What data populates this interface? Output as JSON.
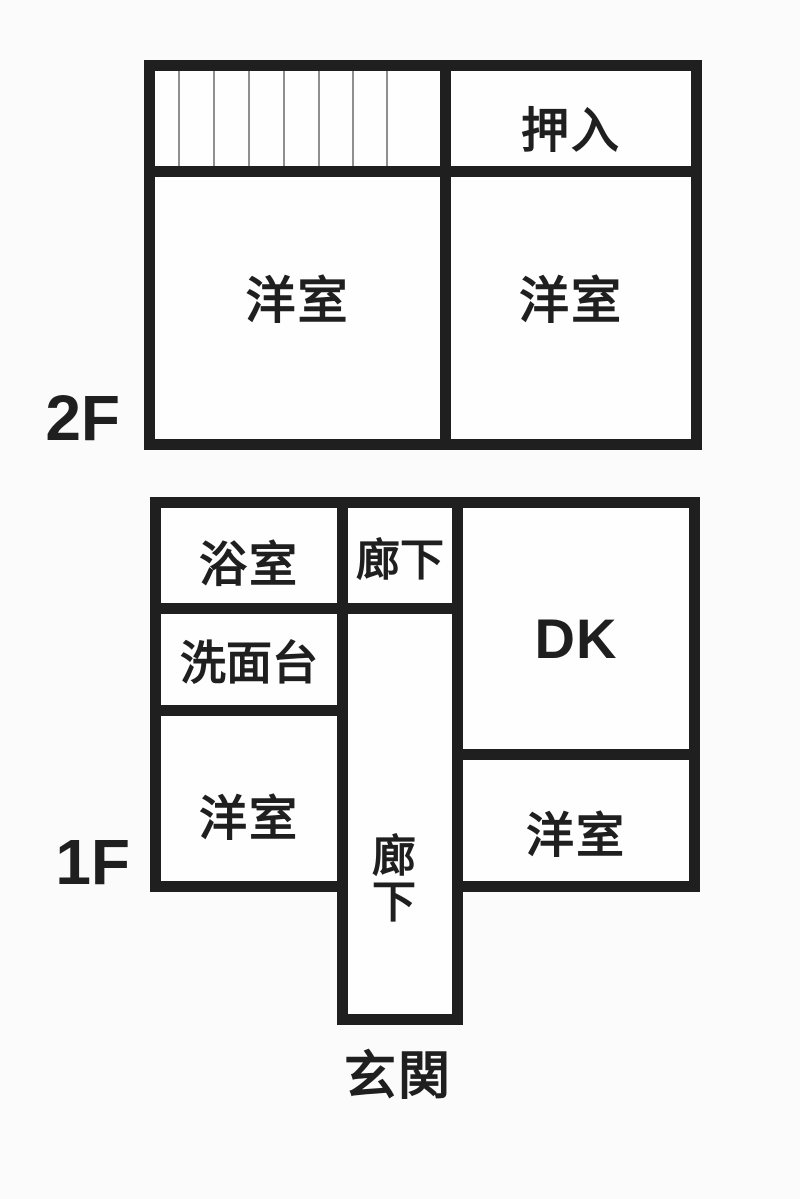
{
  "floorplan": {
    "floor_2f": {
      "label": "2F",
      "rooms": {
        "oshiire": "押入",
        "yoshitsu_left": "洋室",
        "yoshitsu_right": "洋室"
      },
      "stairs_segments": 8
    },
    "floor_1f": {
      "label": "1F",
      "rooms": {
        "bathroom": "浴室",
        "hallway_top": "廊下",
        "dk": "DK",
        "washstand": "洗面台",
        "yoshitsu_left": "洋室",
        "hallway_vertical": "廊下",
        "yoshitsu_right": "洋室"
      },
      "entrance": "玄関"
    }
  },
  "colors": {
    "wall": "#1f1f1f",
    "text": "#1f1f1f",
    "room_fill": "#fefefe",
    "stair_line": "#8f8f8f",
    "background": "#fbfbfb"
  }
}
